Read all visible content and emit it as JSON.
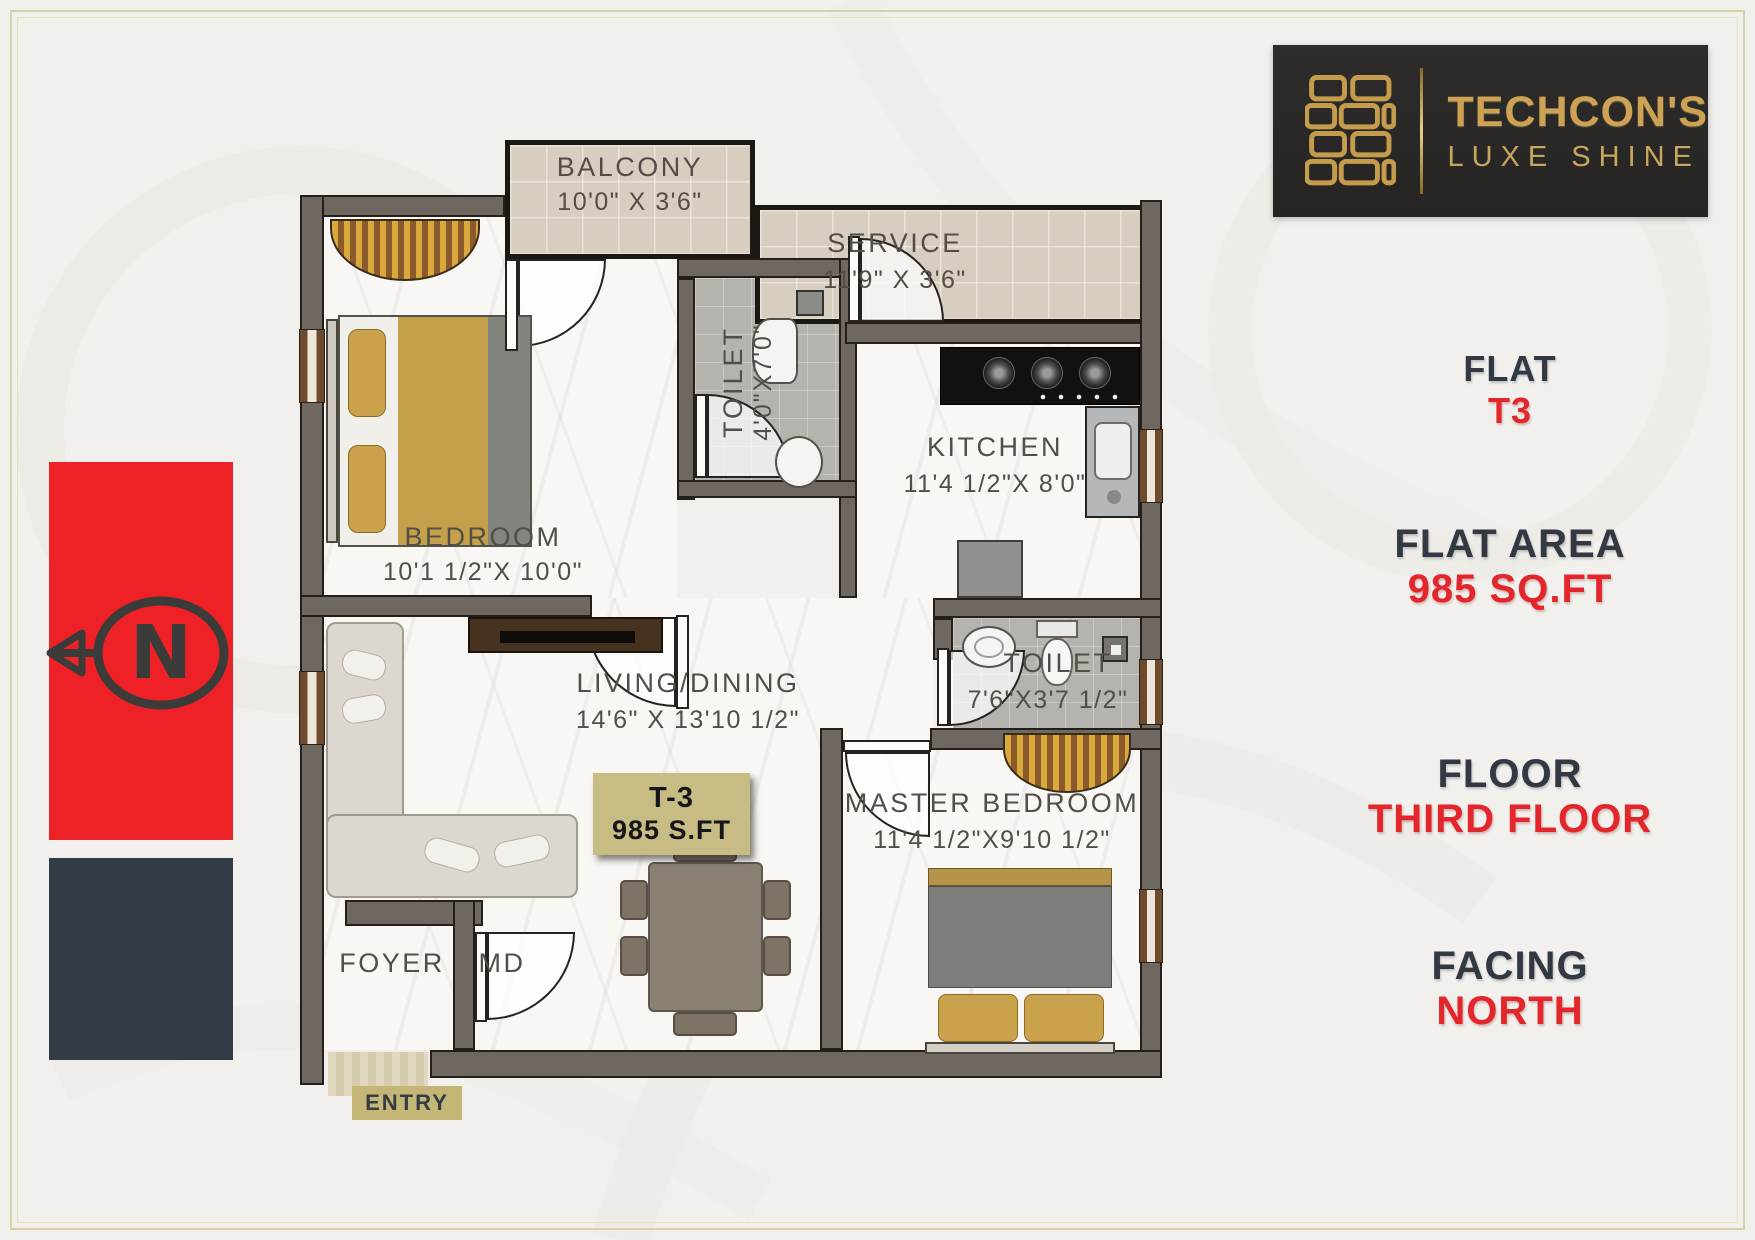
{
  "brand": {
    "name": "TECHCON'S",
    "tagline": "LUXE SHINE"
  },
  "info_panel": {
    "flat": {
      "label": "FLAT",
      "value": "T3"
    },
    "flat_area": {
      "label": "FLAT AREA",
      "value": "985 SQ.FT"
    },
    "floor": {
      "label": "FLOOR",
      "value": "THIRD FLOOR"
    },
    "facing": {
      "label": "FACING",
      "value": "NORTH"
    }
  },
  "compass": {
    "letter": "N"
  },
  "plan": {
    "unit_badge": {
      "unit": "T-3",
      "area": "985 S.FT"
    },
    "entry_label": "ENTRY",
    "rooms": {
      "balcony": {
        "name": "BALCONY",
        "dims": "10'0\" X 3'6\""
      },
      "service": {
        "name": "SERVICE",
        "dims": "11'9\" X 3'6\""
      },
      "toilet_top": {
        "name": "TOILET",
        "dims": "4'0\"X7'0\""
      },
      "kitchen": {
        "name": "KITCHEN",
        "dims": "11'4 1/2\"X 8'0\""
      },
      "bedroom": {
        "name": "BEDROOM",
        "dims": "10'1 1/2\"X 10'0\""
      },
      "living": {
        "name": "LIVING/DINING",
        "dims": "14'6\" X 13'10 1/2\""
      },
      "toilet_right": {
        "name": "TOILET",
        "dims": "7'6\"X3'7 1/2\""
      },
      "master": {
        "name": "MASTER BEDROOM",
        "dims": "11'4 1/2\"X9'10 1/2\""
      },
      "foyer": {
        "name": "FOYER"
      },
      "md": {
        "name": "MD"
      }
    }
  },
  "colors": {
    "accent_red": "#e2262c",
    "gold": "#cda253",
    "navy": "#333b47",
    "wall": "#6f6860",
    "badge": "#c8bc85"
  }
}
